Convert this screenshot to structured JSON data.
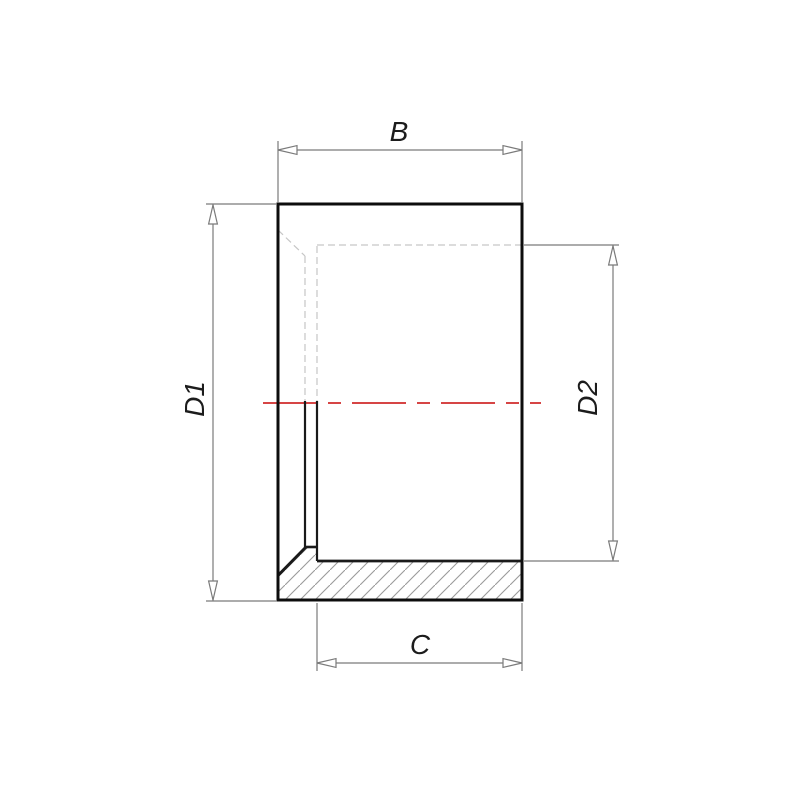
{
  "drawing": {
    "labels": {
      "b": "B",
      "d1": "D1",
      "d2": "D2",
      "c": "C"
    },
    "colors": {
      "background": "#ffffff",
      "outline": "#0d0d0d",
      "inner_edge": "#1a1a1a",
      "hidden_line": "#c6c6c6",
      "hatch_line": "#9a9a9a",
      "dimension_line": "#7a7a7a",
      "arrow_fill": "#ffffff",
      "centerline": "#d64545",
      "label_text": "#1c1c1c"
    }
  }
}
